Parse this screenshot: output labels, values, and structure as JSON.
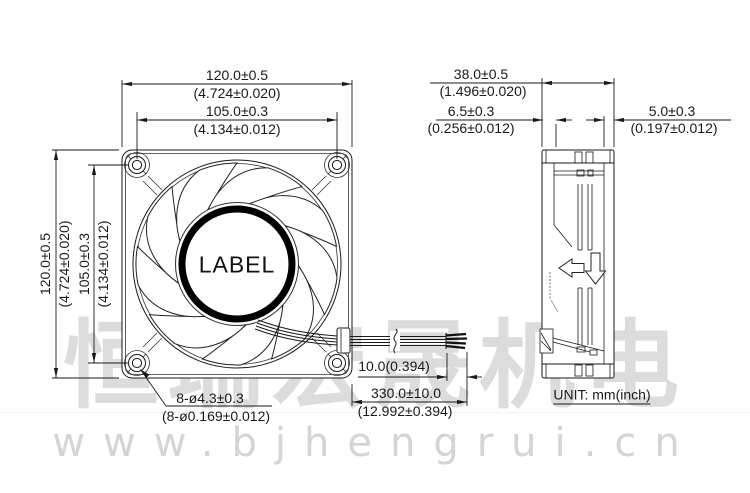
{
  "watermark": {
    "brand_cjk": "恒瑞宏晟机电",
    "website": "www.bjhengrui.cn"
  },
  "unit_note": "UNIT: mm(inch)",
  "front_view": {
    "hub_label": "LABEL",
    "width": {
      "mm": "120.0±0.5",
      "inch": "(4.724±0.020)"
    },
    "hole_pitch_width": {
      "mm": "105.0±0.3",
      "inch": "(4.134±0.012)"
    },
    "height": {
      "mm": "120.0±0.5",
      "inch": "(4.724±0.020)"
    },
    "hole_pitch_height": {
      "mm": "105.0±0.3",
      "inch": "(4.134±0.012)"
    },
    "mounting_holes": {
      "mm": "8-ø4.3±0.3",
      "inch": "(8-ø0.169±0.012)"
    }
  },
  "side_view": {
    "depth": {
      "mm": "38.0±0.5",
      "inch": "(1.496±0.020)"
    },
    "left_wall": {
      "mm": "6.5±0.3",
      "inch": "(0.256±0.012)"
    },
    "right_wall": {
      "mm": "5.0±0.3",
      "inch": "(0.197±0.012)"
    }
  },
  "lead_wire": {
    "strip_length": "10.0(0.394)",
    "length": {
      "mm": "330.0±10.0",
      "inch": "(12.992±0.394)"
    }
  }
}
